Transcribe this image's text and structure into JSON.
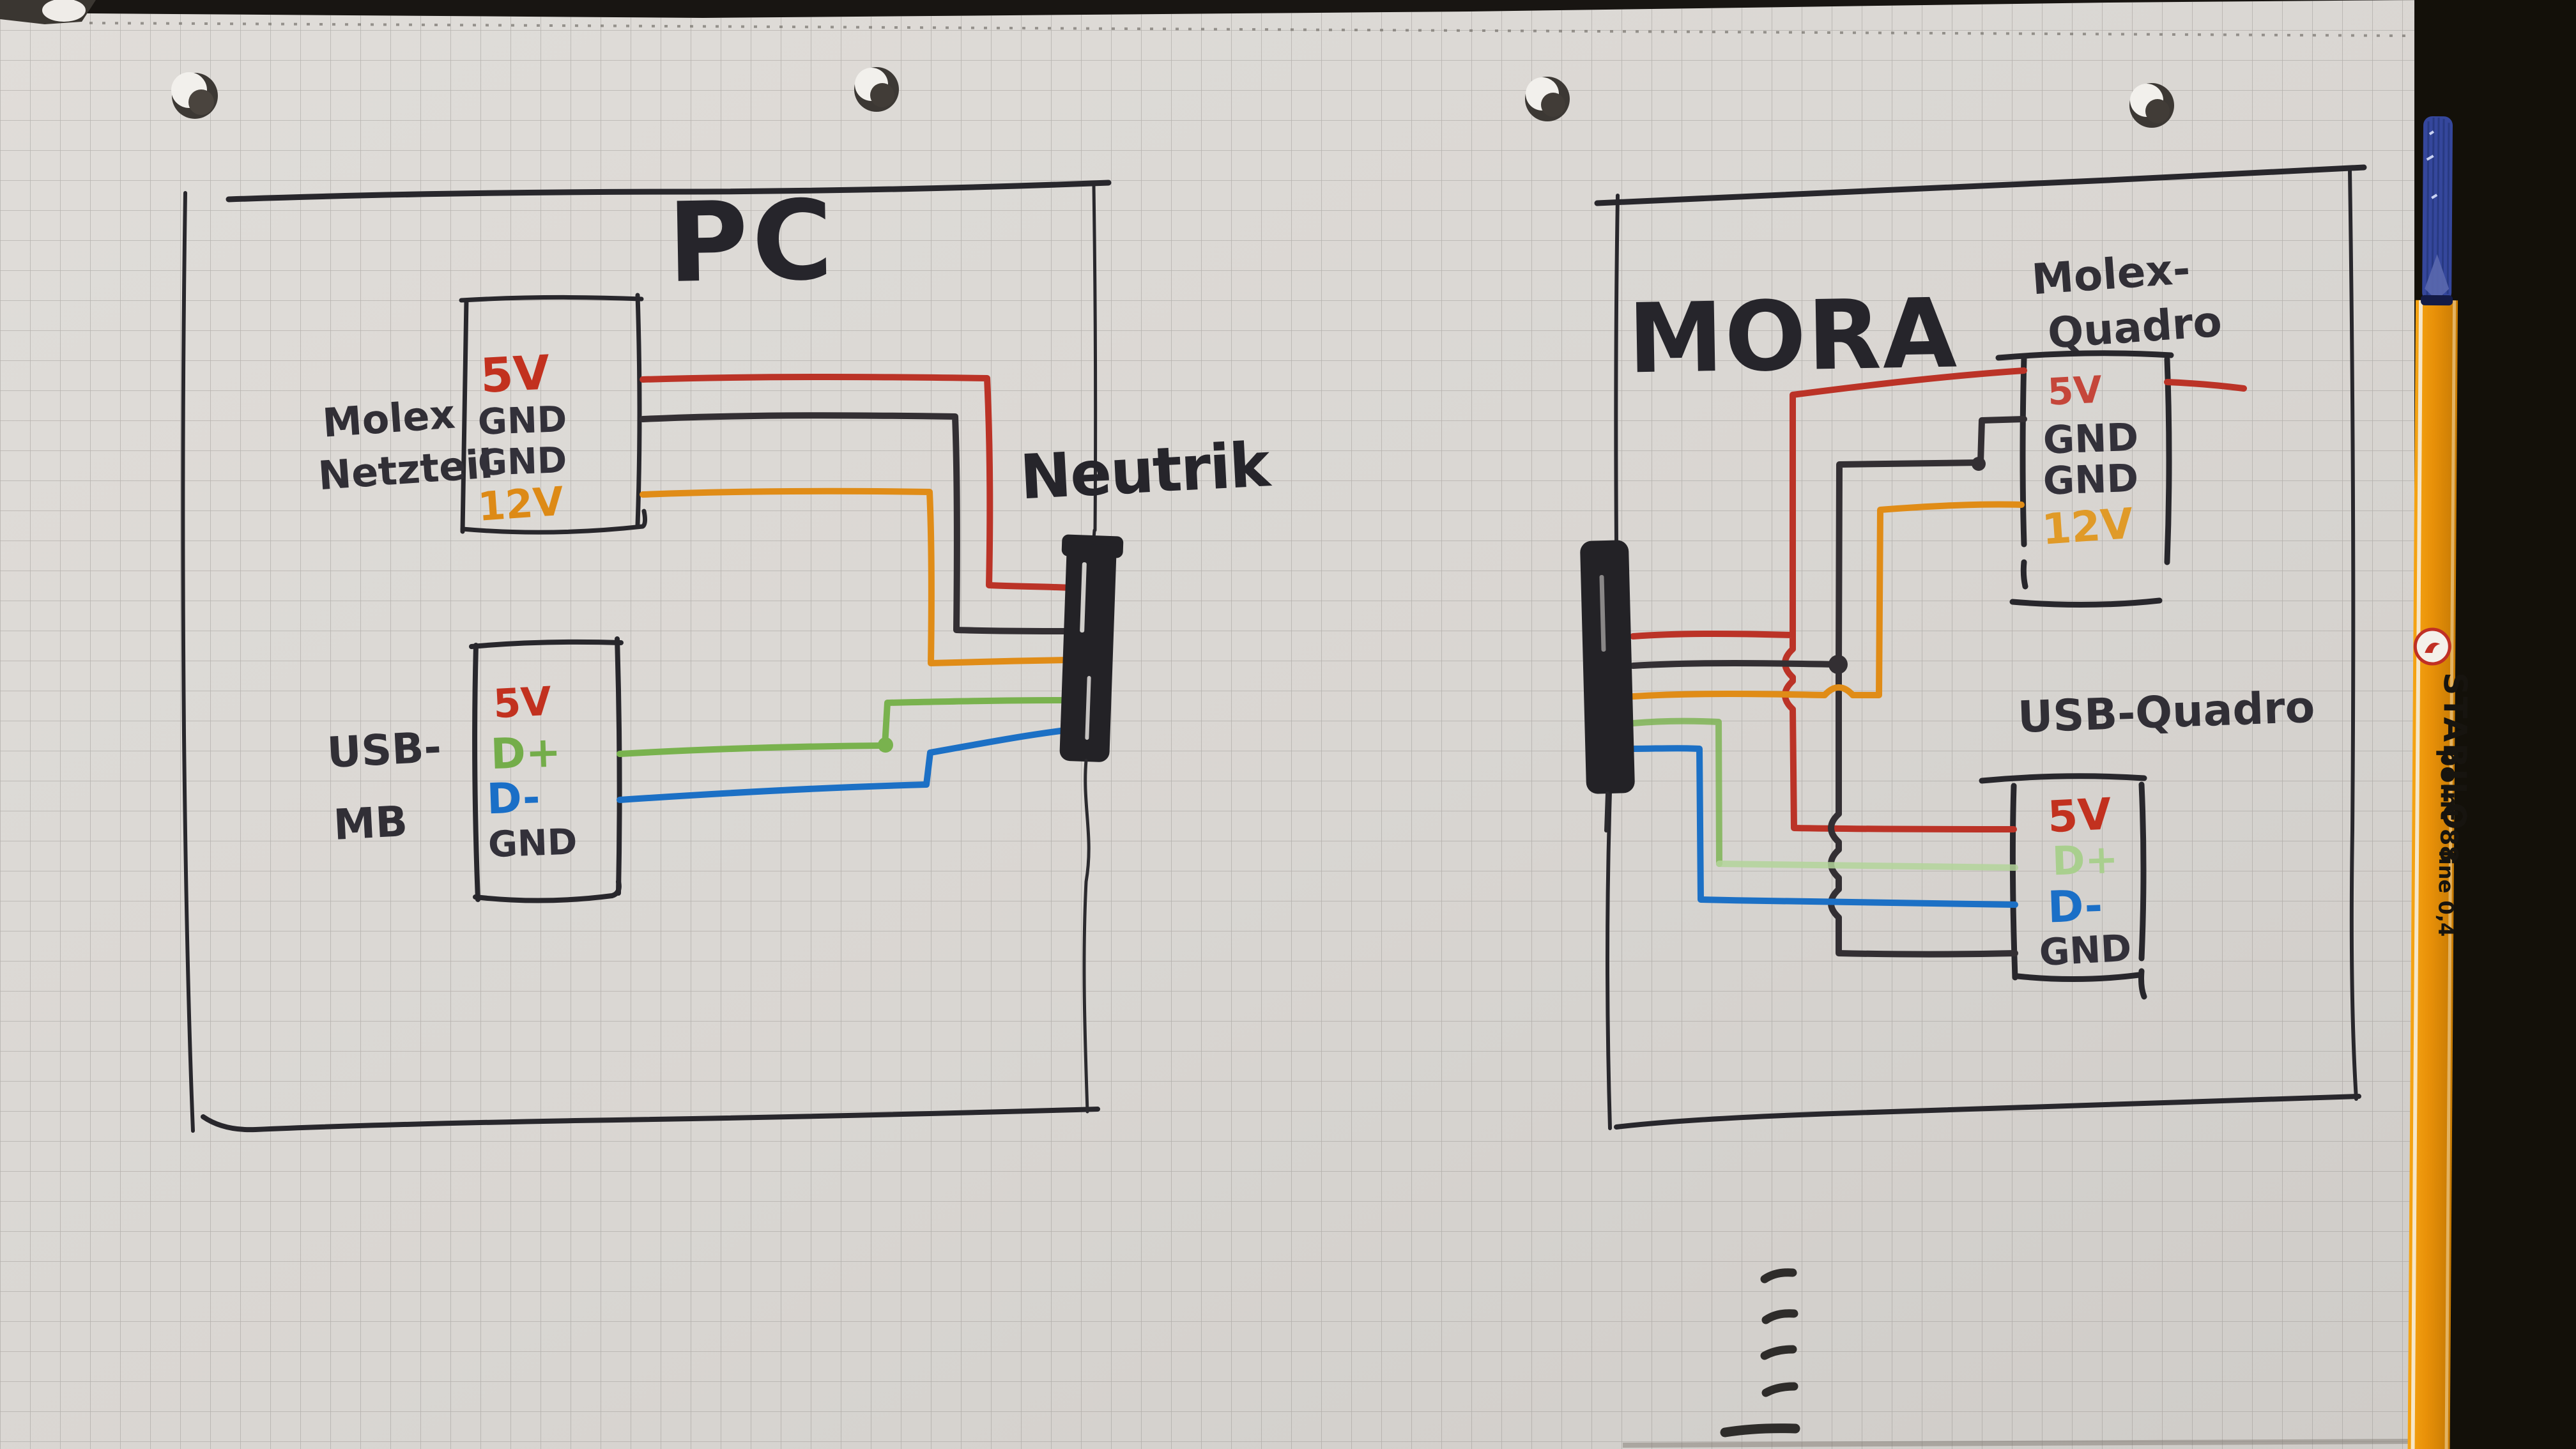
{
  "left_panel": {
    "title": "PC",
    "molex": {
      "label_line1": "Molex",
      "label_line2": "Netzteil",
      "pins": [
        {
          "label": "5V",
          "color": "#c2311f"
        },
        {
          "label": "GND",
          "color": "#33313a"
        },
        {
          "label": "GND",
          "color": "#33313a"
        },
        {
          "label": "12V",
          "color": "#dd8a16"
        }
      ]
    },
    "usb": {
      "label_line1": "USB-",
      "label_line2": "MB",
      "pins": [
        {
          "label": "5V",
          "color": "#c2311f"
        },
        {
          "label": "D+",
          "color": "#74ad4a"
        },
        {
          "label": "D-",
          "color": "#1a6fc7"
        },
        {
          "label": "GND",
          "color": "#33313a"
        }
      ]
    }
  },
  "link": {
    "label": "Neutrik"
  },
  "right_panel": {
    "title": "MORA",
    "molex": {
      "label_line1": "Molex-",
      "label_line2": "Quadro",
      "pins": [
        {
          "label": "5V",
          "color": "#c5463a"
        },
        {
          "label": "GND",
          "color": "#33313a"
        },
        {
          "label": "GND",
          "color": "#33313a"
        },
        {
          "label": "12V",
          "color": "#e09a28"
        }
      ]
    },
    "usb": {
      "label": "USB-Quadro",
      "pins": [
        {
          "label": "5V",
          "color": "#c2311f"
        },
        {
          "label": "D+",
          "color": "#a9cf8e"
        },
        {
          "label": "D-",
          "color": "#1a6fc7"
        },
        {
          "label": "GND",
          "color": "#33313a"
        }
      ]
    }
  },
  "wires": [
    {
      "color": "red",
      "from": "PC Molex Netzteil 5V",
      "to": "MORA Molex-Quadro 5V and USB-Quadro 5V",
      "via": "Neutrik"
    },
    {
      "color": "black",
      "from": "PC Molex Netzteil GND",
      "to": "MORA Molex-Quadro GND and USB-Quadro GND",
      "via": "Neutrik"
    },
    {
      "color": "orange",
      "from": "PC Molex Netzteil 12V",
      "to": "MORA Molex-Quadro 12V",
      "via": "Neutrik"
    },
    {
      "color": "green",
      "from": "PC USB-MB D+",
      "to": "MORA USB-Quadro D+",
      "via": "Neutrik"
    },
    {
      "color": "blue",
      "from": "PC USB-MB D-",
      "to": "MORA USB-Quadro D-",
      "via": "Neutrik"
    }
  ],
  "pen": {
    "brand": "STABILO",
    "model": "point 88",
    "tip_size": "fine 0,4"
  },
  "colors": {
    "wire_red": "#bb3327",
    "wire_black": "#332f33",
    "wire_orange": "#e08c17",
    "wire_green": "#79b24e",
    "wire_green_faded": "#b3d49a",
    "wire_blue": "#1c70c5",
    "marker": "#28272c",
    "pen_orange": "#e89008",
    "pen_cap_blue": "#35479c"
  }
}
